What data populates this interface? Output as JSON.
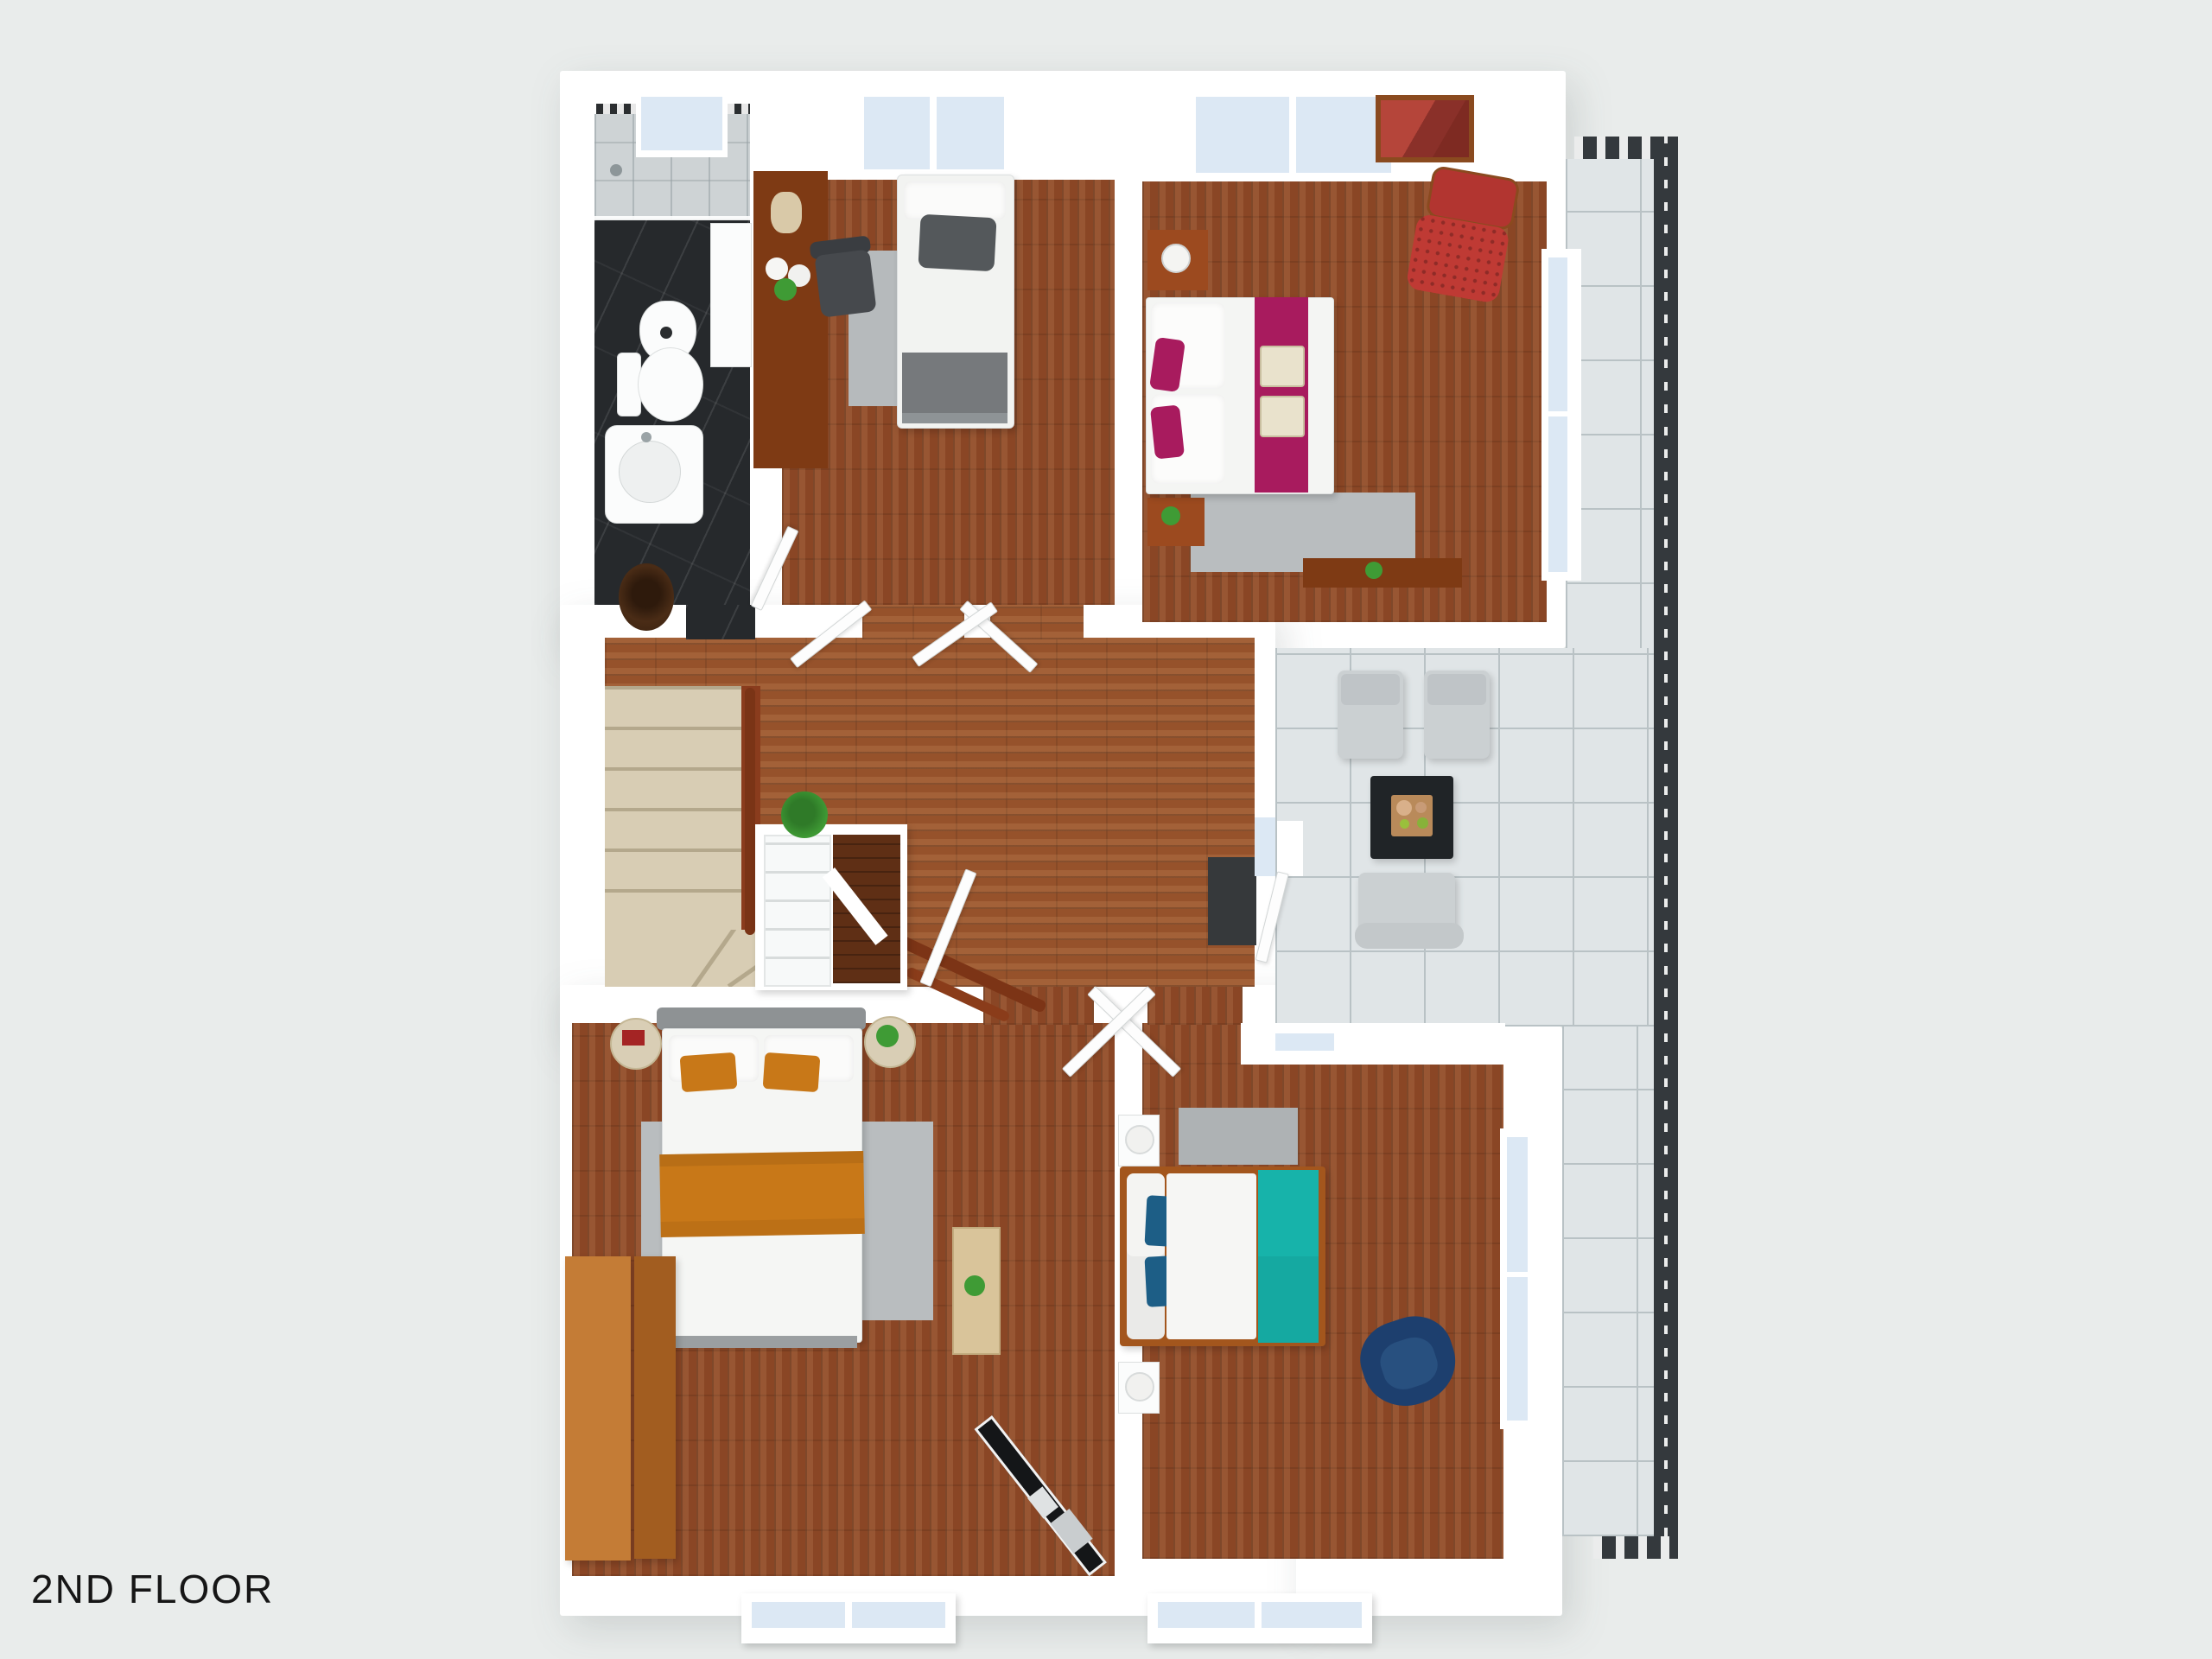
{
  "title": {
    "label": "2ND FLOOR"
  },
  "palette": {
    "bg": "#e9eceb",
    "wall": "#ffffff",
    "glass": "#dce8f4",
    "wood_hall": "#96522b",
    "wood_room": "#8a4625",
    "wood_dark": "#5f2f15",
    "marble": "#26292c",
    "shower_tile": "#ced3d5",
    "terrace_tile": "#e0e5e7",
    "tile_line": "#b9c2c5",
    "railing": "#34393d",
    "stair": "#d8cdb4",
    "stair_dark": "#b4a88c",
    "wood_furniture": "#9c4a1f",
    "wood_furniture_dark": "#7e3a14",
    "wardrobe_light": "#c47c36",
    "wardrobe_dark": "#a25d20",
    "rug": "#b9bdbf",
    "rug_dark": "#aeb2b4",
    "mat": "#36393b",
    "magenta": "#a81b5e",
    "orange": "#c87818",
    "teal": "#17b3aa",
    "navy": "#1d5e86",
    "navy_chair": "#1d3f6e",
    "red_chair": "#bf3a34",
    "plant": "#3f9b35",
    "gray_cushion": "#cbd0d2",
    "black_table": "#202427",
    "textile_gray": "#54585b"
  },
  "rooms": [
    {
      "id": "bathroom",
      "furniture": [
        "shower",
        "bidet",
        "toilet",
        "sink",
        "skylight"
      ]
    },
    {
      "id": "bedroom-single",
      "furniture": [
        "desk",
        "desk-chair",
        "single-bed",
        "rug",
        "skylight"
      ]
    },
    {
      "id": "bedroom-master",
      "furniture": [
        "double-bed-magenta",
        "nightstands",
        "red-chair",
        "mirror",
        "sideboard",
        "rug",
        "skylight",
        "window"
      ]
    },
    {
      "id": "hallway",
      "furniture": [
        "staircase",
        "handrail",
        "open-shelf",
        "plant",
        "vase",
        "dark-mat",
        "doors"
      ]
    },
    {
      "id": "bedroom-orange",
      "furniture": [
        "double-bed-orange",
        "round-side-tables",
        "wardrobe",
        "coffee-table",
        "exercise-machine",
        "rug",
        "window"
      ]
    },
    {
      "id": "bedroom-teal",
      "furniture": [
        "double-bed-teal",
        "white-nightstands",
        "navy-armchair",
        "rug",
        "windows",
        "terrace-door"
      ]
    },
    {
      "id": "terrace",
      "furniture": [
        "lounge-chairs",
        "black-coffee-table",
        "outdoor-chair",
        "railing",
        "tile-floor"
      ]
    }
  ]
}
